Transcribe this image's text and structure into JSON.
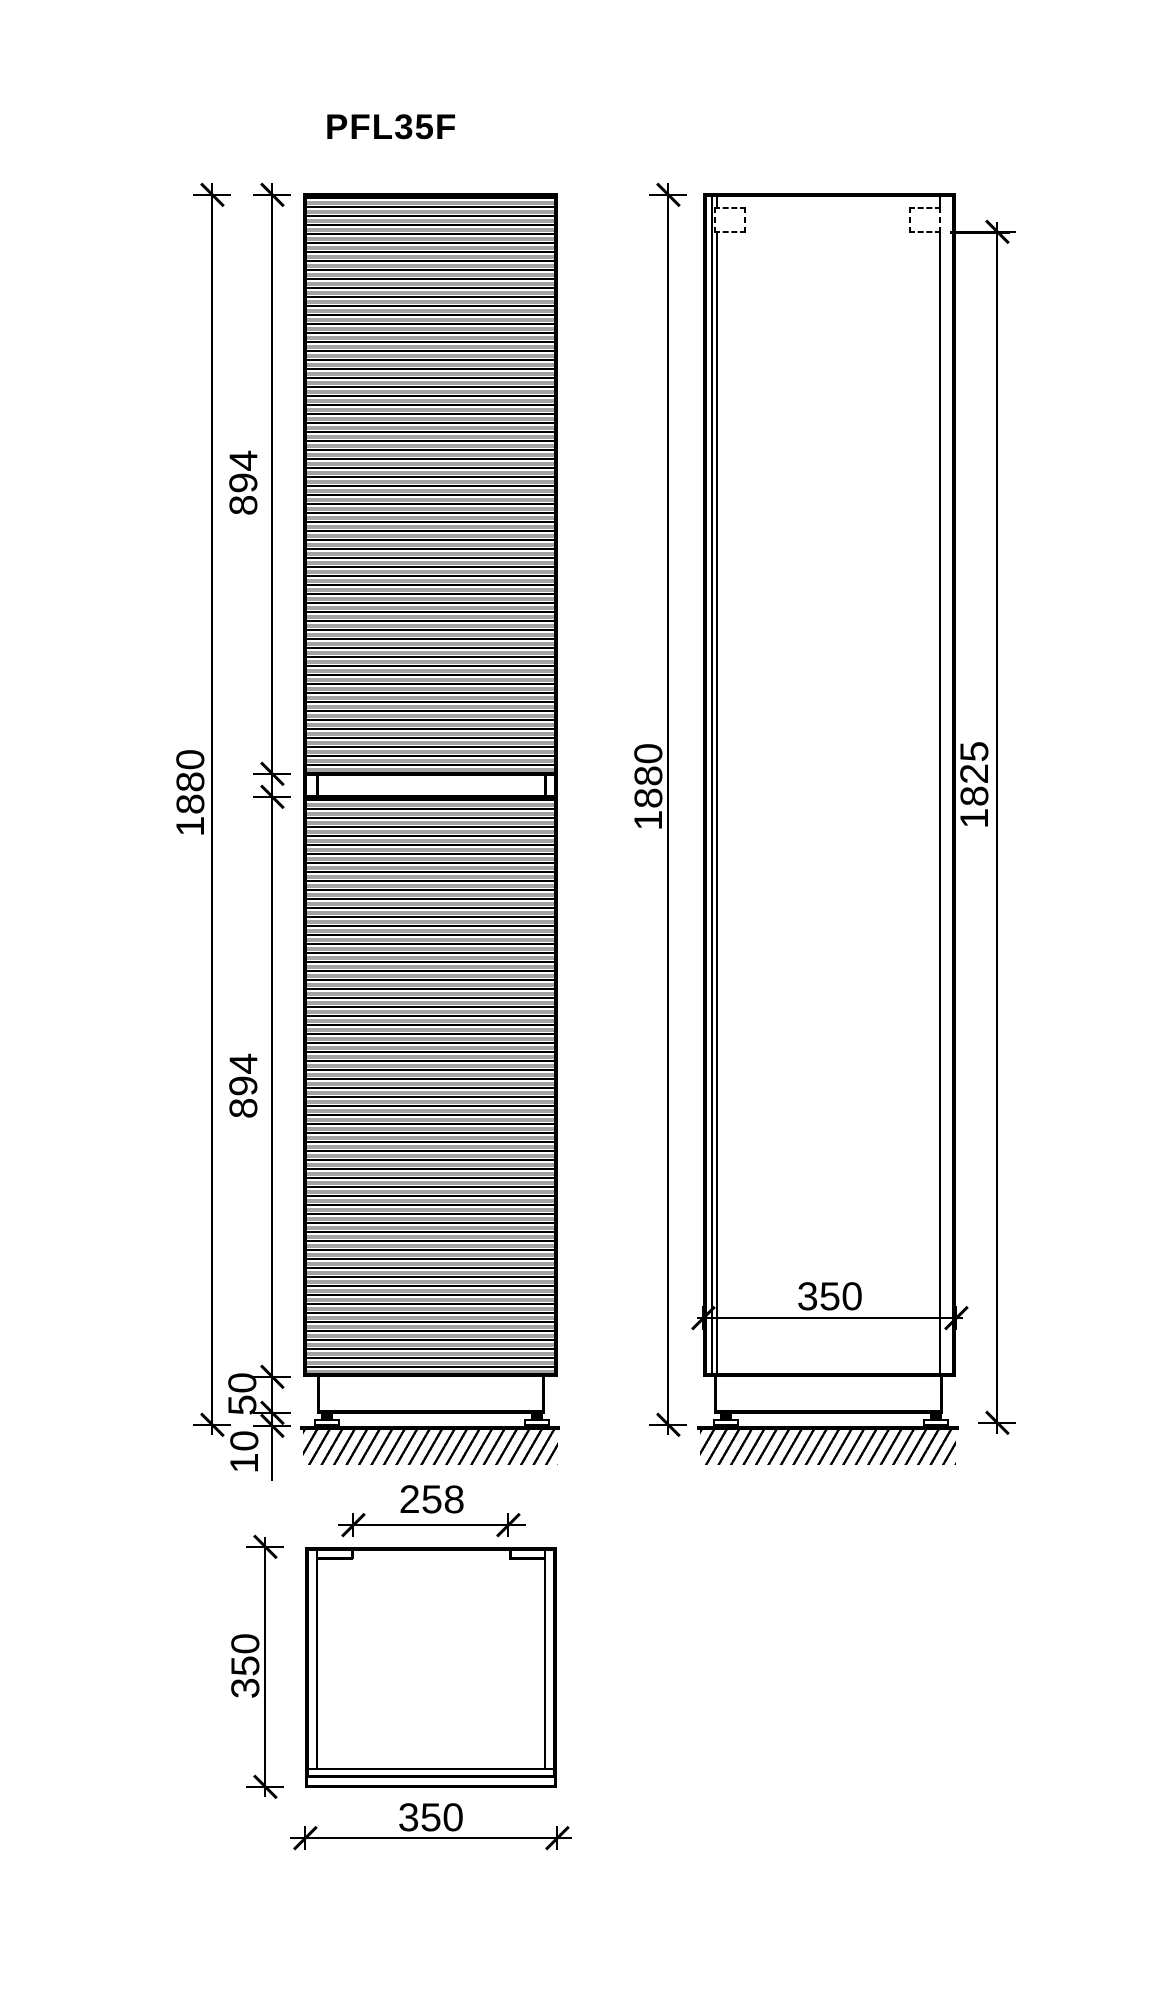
{
  "title": "PFL35F",
  "colors": {
    "line": "#000000",
    "background": "#ffffff"
  },
  "front_view": {
    "height_total": "1880",
    "upper_door": "894",
    "lower_door": "894",
    "plinth": "50",
    "feet": "10"
  },
  "side_view": {
    "height_total": "1880",
    "mount_height": "1825",
    "depth": "350"
  },
  "plan_view": {
    "opening": "258",
    "depth": "350",
    "width": "350"
  }
}
